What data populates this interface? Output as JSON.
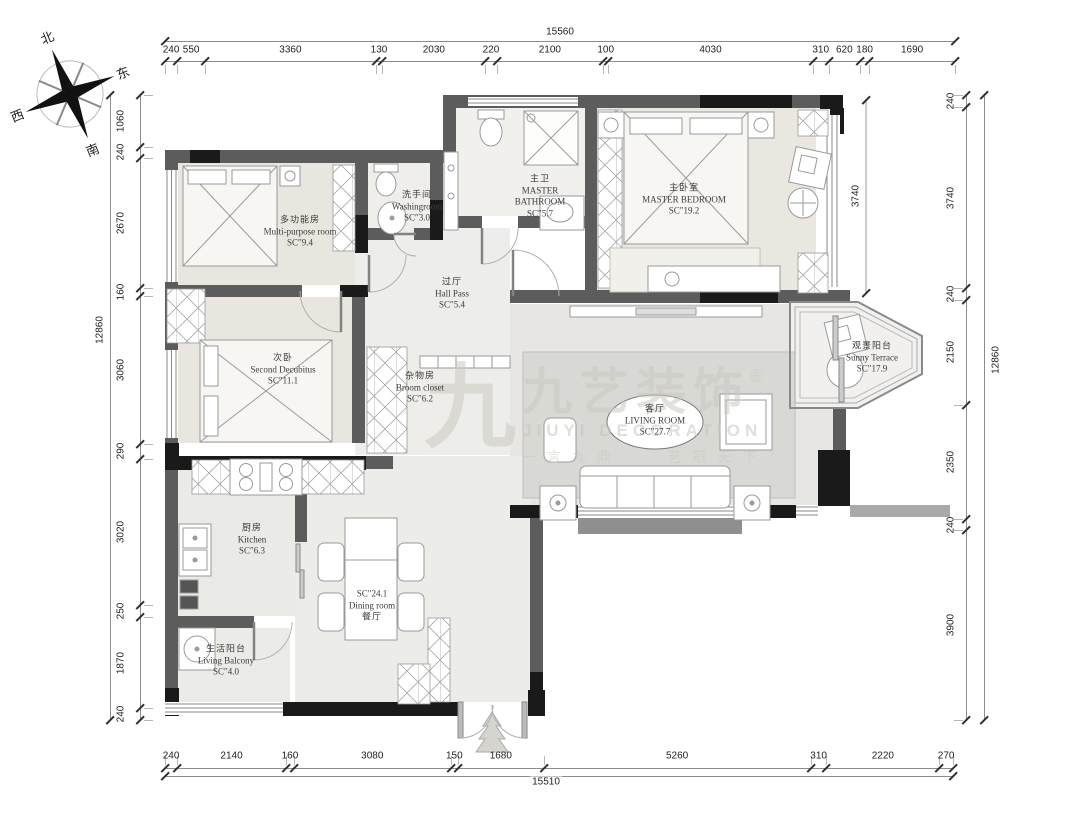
{
  "compass": {
    "n": "北",
    "e": "东",
    "s": "南",
    "w": "西"
  },
  "watermark": {
    "glyph": "九",
    "brand": "九艺装饰",
    "reg": "®",
    "latin": "JIUYI DECORATION",
    "slogan": "一言九鼎 · 艺冠天下"
  },
  "dimensions": {
    "top": {
      "total": "15560",
      "segments": [
        "240",
        "550",
        "3360",
        "130",
        "2030",
        "220",
        "2100",
        "100",
        "4030",
        "310",
        "620",
        "180",
        "1690"
      ]
    },
    "bottom": {
      "total": "15510",
      "segments": [
        "240",
        "2140",
        "160",
        "3080",
        "150",
        "1680",
        "5260",
        "310",
        "2220",
        "270"
      ]
    },
    "left": {
      "total": "12860",
      "segments": [
        "1060",
        "240",
        "2670",
        "160",
        "3060",
        "290",
        "3020",
        "250",
        "1870",
        "240"
      ]
    },
    "right": {
      "total": "12860",
      "segments": [
        "240",
        "3740",
        "240",
        "2150",
        "2350",
        "240",
        "3900"
      ]
    },
    "inner": [
      "3740"
    ]
  },
  "rooms": [
    {
      "id": "multi-purpose",
      "lines": [
        "多功能房",
        "Multi-purpose room",
        "SC″9.4"
      ]
    },
    {
      "id": "washingroom",
      "lines": [
        "洗手间",
        "Washingroom",
        "SC″3.0"
      ]
    },
    {
      "id": "master-bathroom",
      "lines": [
        "主卫",
        "MASTER",
        "BATHROOM",
        "SC″5.7"
      ]
    },
    {
      "id": "master-bedroom",
      "lines": [
        "主卧室",
        "MASTER BEDROOM",
        "SC″19.2"
      ]
    },
    {
      "id": "hall-pass",
      "lines": [
        "过厅",
        "Hall Pass",
        "SC″5.4"
      ]
    },
    {
      "id": "second-bedroom",
      "lines": [
        "次卧",
        "Second Decubitus",
        "SC″11.1"
      ]
    },
    {
      "id": "broom-closet",
      "lines": [
        "杂物房",
        "Broom closet",
        "SC″6.2"
      ]
    },
    {
      "id": "living-room",
      "lines": [
        "客厅",
        "LIVING ROOM",
        "SC″27.7"
      ]
    },
    {
      "id": "sunny-terrace",
      "lines": [
        "观景阳台",
        "Sunny Terrace",
        "SC″17.9"
      ]
    },
    {
      "id": "kitchen",
      "lines": [
        "厨房",
        "Kitchen",
        "SC″6.3"
      ]
    },
    {
      "id": "dining-room",
      "lines": [
        "SC″24.1",
        "Dining room",
        "餐厅"
      ]
    },
    {
      "id": "living-balcony",
      "lines": [
        "生活阳台",
        "Living Balcony",
        "SC″4.0"
      ]
    }
  ]
}
